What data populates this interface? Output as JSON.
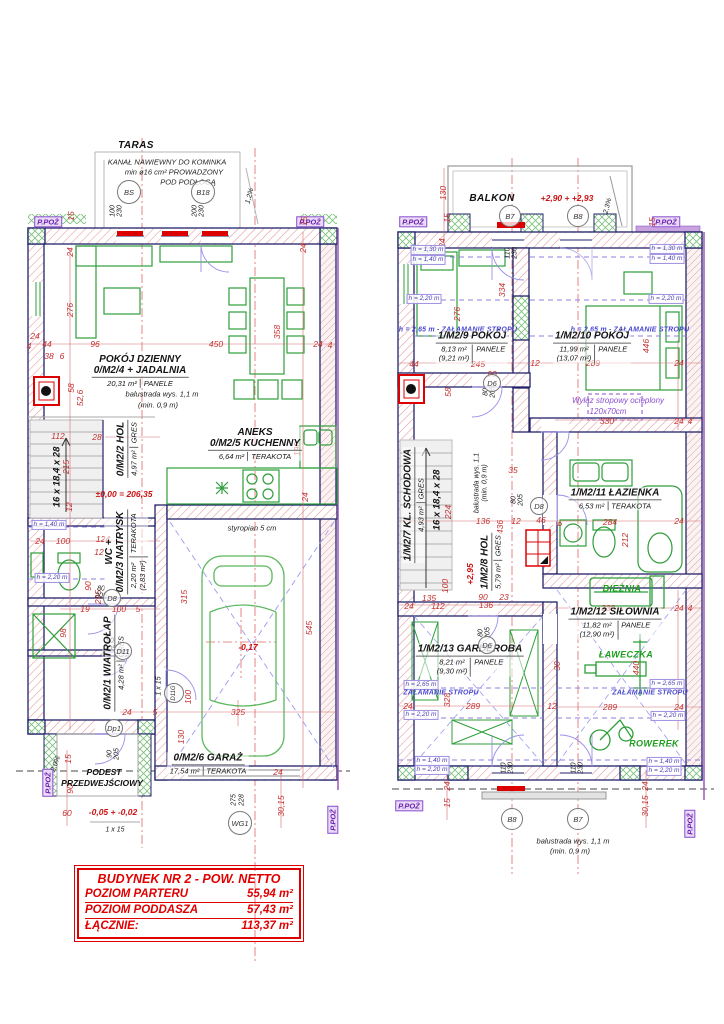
{
  "summary": {
    "header": "BUDYNEK NR 2 - POW. NETTO",
    "rows": [
      {
        "label": "POZIOM PARTERU",
        "value": "55,94 m²"
      },
      {
        "label": "POZIOM PODDASZA",
        "value": "57,43 m²"
      },
      {
        "label": "ŁĄCZNIE:",
        "value": "113,37 m²"
      }
    ]
  },
  "colors": {
    "wall_outline": "#23236b",
    "dimension_red": "#c43030",
    "furniture_green": "#2e9e3a",
    "fire_purple": "#8a4fd0",
    "table_red": "#e10000"
  },
  "rooms": [
    {
      "id": "0/M2/4",
      "name": "POKÓJ DZIENNY",
      "name2": "+ JADALNIA",
      "area": "20,31 m²",
      "finish": "PANELE",
      "x": 140,
      "y": 371,
      "vert": false
    },
    {
      "id": "0/M2/5",
      "name": "ANEKS",
      "name2": "KUCHENNY",
      "area": "6,64 m²",
      "finish": "TERAKOTA",
      "x": 255,
      "y": 444,
      "vert": false
    },
    {
      "id": "0/M2/2",
      "name": "HOL",
      "area": "4,97 m²",
      "finish": "GRES",
      "x": 127,
      "y": 449,
      "vert": true
    },
    {
      "id": "0/M2/3",
      "name": "WC +",
      "name2": "NATRYSK",
      "area": "2,20 m²",
      "area2": "(2,83 m²)",
      "finish": "TERAKOTA",
      "x": 126,
      "y": 552,
      "vert": true
    },
    {
      "id": "0/M2/1",
      "name": "WIATROŁAP",
      "area": "4,28 m²",
      "finish": "GRES",
      "x": 114,
      "y": 663,
      "vert": true
    },
    {
      "id": "0/M2/6",
      "name": "GARAŻ",
      "area": "17,54 m²",
      "finish": "TERAKOTA",
      "x": 208,
      "y": 764,
      "vert": false
    },
    {
      "id": "1/M2/9",
      "name": "POKÓJ",
      "area": "8,13 m²",
      "area2": "(9,21 m²)",
      "finish": "PANELE",
      "x": 472,
      "y": 347,
      "vert": false
    },
    {
      "id": "1/M2/10",
      "name": "POKÓJ",
      "area": "11,99 m²",
      "area2": "(13,07 m²)",
      "finish": "PANELE",
      "x": 592,
      "y": 347,
      "vert": false
    },
    {
      "id": "1/M2/7",
      "name": "KL. SCHODOWA",
      "area": "4,93 m²",
      "finish": "GRES",
      "x": 414,
      "y": 505,
      "vert": true
    },
    {
      "id": "1/M2/8",
      "name": "HOL",
      "area": "5,79 m²",
      "finish": "GRES",
      "x": 491,
      "y": 562,
      "vert": true
    },
    {
      "id": "1/M2/11",
      "name": "ŁAZIENKA",
      "area": "6,53 m²",
      "finish": "TERAKOTA",
      "x": 615,
      "y": 499,
      "vert": false
    },
    {
      "id": "1/M2/12",
      "name": "SIŁOWNIA",
      "area": "11,82 m²",
      "area2": "(12,90 m²)",
      "finish": "PANELE",
      "x": 615,
      "y": 623,
      "vert": false
    },
    {
      "id": "1/M2/13",
      "name": "GARDEROBA",
      "area": "8,21 m²",
      "area2": "(9,30 m²)",
      "finish": "PANELE",
      "x": 470,
      "y": 660,
      "vert": false
    }
  ],
  "markers": [
    {
      "t": "BS",
      "x": 129,
      "y": 192,
      "r": 11
    },
    {
      "t": "B18",
      "x": 203,
      "y": 192,
      "r": 11
    },
    {
      "t": "D8",
      "x": 112,
      "y": 598,
      "r": 8
    },
    {
      "t": "D11",
      "x": 123,
      "y": 651,
      "r": 8
    },
    {
      "t": "D11G",
      "x": 174,
      "y": 693,
      "r": 9,
      "rot": -90
    },
    {
      "t": "Dp1",
      "x": 114,
      "y": 728,
      "r": 8
    },
    {
      "t": "WG1",
      "x": 240,
      "y": 823,
      "r": 11
    },
    {
      "t": "B7",
      "x": 510,
      "y": 216,
      "r": 10
    },
    {
      "t": "B8",
      "x": 578,
      "y": 216,
      "r": 10
    },
    {
      "t": "D6",
      "x": 492,
      "y": 383,
      "r": 8
    },
    {
      "t": "D8",
      "x": 539,
      "y": 506,
      "r": 8
    },
    {
      "t": "D6",
      "x": 487,
      "y": 645,
      "r": 8
    },
    {
      "t": "B8",
      "x": 512,
      "y": 819,
      "r": 10
    },
    {
      "t": "B7",
      "x": 578,
      "y": 819,
      "r": 10
    }
  ],
  "annotations": [
    {
      "t": "TARAS",
      "x": 136,
      "y": 146,
      "c": "nb"
    },
    {
      "t": "KANAŁ NAWIEWNY DO KOMINKA",
      "x": 167,
      "y": 162,
      "c": "n"
    },
    {
      "t": "min ø16 cm² PROWADZONY",
      "x": 174,
      "y": 172,
      "c": "n"
    },
    {
      "t": "POD PODŁOGĄ",
      "x": 188,
      "y": 182,
      "c": "n"
    },
    {
      "t": "100",
      "x": 113,
      "y": 211,
      "c": "k",
      "r": -90
    },
    {
      "t": "230",
      "x": 120,
      "y": 211,
      "c": "k",
      "r": -90
    },
    {
      "t": "200",
      "x": 195,
      "y": 211,
      "c": "k",
      "r": -90
    },
    {
      "t": "230",
      "x": 202,
      "y": 211,
      "c": "k",
      "r": -90
    },
    {
      "t": "1,2%",
      "x": 250,
      "y": 196,
      "c": "k",
      "r": -75
    },
    {
      "t": "P.POŻ",
      "x": 48,
      "y": 222,
      "c": "p"
    },
    {
      "t": "P.POŻ",
      "x": 310,
      "y": 222,
      "c": "p"
    },
    {
      "t": "15",
      "x": 304,
      "y": 221,
      "r": -90
    },
    {
      "t": "24",
      "x": 303,
      "y": 248,
      "r": -90
    },
    {
      "t": "15",
      "x": 71,
      "y": 216,
      "r": -90
    },
    {
      "t": "24",
      "x": 70,
      "y": 252,
      "r": -90
    },
    {
      "t": "276",
      "x": 70,
      "y": 310,
      "r": -90
    },
    {
      "t": "96",
      "x": 95,
      "y": 344
    },
    {
      "t": "44",
      "x": 47,
      "y": 344
    },
    {
      "t": "38",
      "x": 49,
      "y": 356
    },
    {
      "t": "6",
      "x": 62,
      "y": 356
    },
    {
      "t": "24",
      "x": 35,
      "y": 336
    },
    {
      "t": "4",
      "x": 29,
      "y": 346
    },
    {
      "t": "58",
      "x": 71,
      "y": 388,
      "r": -90
    },
    {
      "t": "52,6",
      "x": 80,
      "y": 398,
      "r": -90
    },
    {
      "t": "450",
      "x": 216,
      "y": 344
    },
    {
      "t": "358",
      "x": 277,
      "y": 332,
      "r": -90
    },
    {
      "t": "24",
      "x": 318,
      "y": 344
    },
    {
      "t": "4",
      "x": 330,
      "y": 345
    },
    {
      "t": "balustrada wys. 1,1 m",
      "x": 162,
      "y": 394,
      "c": "n"
    },
    {
      "t": "(min. 0,9 m)",
      "x": 158,
      "y": 405,
      "c": "n"
    },
    {
      "t": "112",
      "x": 58,
      "y": 436
    },
    {
      "t": "28",
      "x": 97,
      "y": 437
    },
    {
      "t": "215",
      "x": 66,
      "y": 467,
      "r": -90
    },
    {
      "t": "16 x 18,4 x 28",
      "x": 57,
      "y": 477,
      "c": "kb",
      "r": -90
    },
    {
      "t": "190",
      "x": 297,
      "y": 449,
      "r": -90
    },
    {
      "t": "±0,00 = 206,35",
      "x": 124,
      "y": 494,
      "c": "lv"
    },
    {
      "t": "12",
      "x": 69,
      "y": 507,
      "r": -90
    },
    {
      "t": "24",
      "x": 40,
      "y": 541
    },
    {
      "t": "100",
      "x": 63,
      "y": 541
    },
    {
      "t": "124",
      "x": 103,
      "y": 539
    },
    {
      "t": "12",
      "x": 99,
      "y": 552
    },
    {
      "t": "h = 1,40 m",
      "x": 49,
      "y": 525,
      "c": "hb"
    },
    {
      "t": "h = 2,20 m",
      "x": 52,
      "y": 578,
      "c": "hb"
    },
    {
      "t": "90",
      "x": 88,
      "y": 586,
      "r": -90
    },
    {
      "t": "295",
      "x": 98,
      "y": 597,
      "r": -90
    },
    {
      "t": "80",
      "x": 101,
      "y": 589,
      "c": "k"
    },
    {
      "t": "205",
      "x": 101,
      "y": 596,
      "c": "k"
    },
    {
      "t": "19",
      "x": 85,
      "y": 609
    },
    {
      "t": "100",
      "x": 119,
      "y": 609
    },
    {
      "t": "5",
      "x": 138,
      "y": 609
    },
    {
      "t": "98",
      "x": 63,
      "y": 633,
      "r": -90
    },
    {
      "t": "90",
      "x": 110,
      "y": 641,
      "c": "k"
    },
    {
      "t": "205",
      "x": 110,
      "y": 649,
      "c": "k"
    },
    {
      "t": "315",
      "x": 184,
      "y": 597,
      "r": -90
    },
    {
      "t": "1 x 15",
      "x": 159,
      "y": 686,
      "c": "k",
      "r": -90
    },
    {
      "t": "24",
      "x": 127,
      "y": 712
    },
    {
      "t": "5",
      "x": 155,
      "y": 712
    },
    {
      "t": "100",
      "x": 188,
      "y": 697,
      "r": -90
    },
    {
      "t": "325",
      "x": 238,
      "y": 712
    },
    {
      "t": "130",
      "x": 181,
      "y": 737,
      "r": -90
    },
    {
      "t": "545",
      "x": 309,
      "y": 628,
      "r": -90
    },
    {
      "t": "-0,17",
      "x": 248,
      "y": 647,
      "c": "lv"
    },
    {
      "t": "styropian 5 cm",
      "x": 252,
      "y": 528,
      "c": "n"
    },
    {
      "t": "24",
      "x": 305,
      "y": 497,
      "r": -90
    },
    {
      "t": "24",
      "x": 278,
      "y": 772
    },
    {
      "t": "30,15",
      "x": 281,
      "y": 806,
      "r": -90
    },
    {
      "t": "275",
      "x": 234,
      "y": 800,
      "c": "k",
      "r": -90
    },
    {
      "t": "228",
      "x": 242,
      "y": 800,
      "c": "k",
      "r": -90
    },
    {
      "t": "P.POŻ",
      "x": 48,
      "y": 783,
      "c": "p",
      "r": -90
    },
    {
      "t": "2,0%",
      "x": 56,
      "y": 764,
      "c": "k",
      "r": -70
    },
    {
      "t": "15",
      "x": 68,
      "y": 759,
      "r": -90
    },
    {
      "t": "90",
      "x": 70,
      "y": 789,
      "r": -90
    },
    {
      "t": "60",
      "x": 67,
      "y": 813
    },
    {
      "t": "-0,05 + -0,02",
      "x": 113,
      "y": 812,
      "c": "lv"
    },
    {
      "t": "1 x 15",
      "x": 115,
      "y": 830,
      "c": "k"
    },
    {
      "t": "90",
      "x": 110,
      "y": 754,
      "c": "k",
      "r": -90
    },
    {
      "t": "205",
      "x": 117,
      "y": 754,
      "c": "k",
      "r": -90
    },
    {
      "t": "PODEST",
      "x": 104,
      "y": 772,
      "c": "nb2"
    },
    {
      "t": "PRZEDWEJŚCIOWY",
      "x": 102,
      "y": 783,
      "c": "nb2"
    },
    {
      "t": "P.POŻ",
      "x": 333,
      "y": 820,
      "c": "p",
      "r": -90
    },
    {
      "t": "BALKON",
      "x": 492,
      "y": 199,
      "c": "nb"
    },
    {
      "t": "+2,90 + +2,93",
      "x": 567,
      "y": 198,
      "c": "lv"
    },
    {
      "t": "2,3%",
      "x": 608,
      "y": 206,
      "c": "k",
      "r": -75
    },
    {
      "t": "130",
      "x": 443,
      "y": 193,
      "r": -90
    },
    {
      "t": "15",
      "x": 447,
      "y": 218,
      "r": -90
    },
    {
      "t": "24",
      "x": 442,
      "y": 243,
      "r": -90
    },
    {
      "t": "P.POŻ",
      "x": 413,
      "y": 222,
      "c": "p"
    },
    {
      "t": "P.POŻ",
      "x": 666,
      "y": 222,
      "c": "p"
    },
    {
      "t": "15",
      "x": 652,
      "y": 222,
      "r": -90
    },
    {
      "t": "110",
      "x": 508,
      "y": 253,
      "c": "k",
      "r": -90
    },
    {
      "t": "230",
      "x": 515,
      "y": 253,
      "c": "k",
      "r": -90
    },
    {
      "t": "h = 1,30 m",
      "x": 428,
      "y": 250,
      "c": "hb"
    },
    {
      "t": "h = 1,40 m",
      "x": 428,
      "y": 260,
      "c": "hb"
    },
    {
      "t": "h = 2,20 m",
      "x": 424,
      "y": 299,
      "c": "hb"
    },
    {
      "t": "h = 2,65 m - ZAŁAMANIE STROPU",
      "x": 458,
      "y": 330,
      "c": "st"
    },
    {
      "t": "h = 1,30 m",
      "x": 667,
      "y": 249,
      "c": "hb"
    },
    {
      "t": "h = 1,40 m",
      "x": 667,
      "y": 259,
      "c": "hb"
    },
    {
      "t": "h = 2,20 m",
      "x": 666,
      "y": 299,
      "c": "hb"
    },
    {
      "t": "h = 2,65 m - ZAŁAMANIE STROPU",
      "x": 630,
      "y": 330,
      "c": "st"
    },
    {
      "t": "334",
      "x": 502,
      "y": 290,
      "r": -90
    },
    {
      "t": "276",
      "x": 457,
      "y": 314,
      "r": -90
    },
    {
      "t": "44",
      "x": 414,
      "y": 364
    },
    {
      "t": "245",
      "x": 478,
      "y": 364
    },
    {
      "t": "58",
      "x": 448,
      "y": 392,
      "r": -90
    },
    {
      "t": "90",
      "x": 492,
      "y": 374
    },
    {
      "t": "80",
      "x": 486,
      "y": 392,
      "c": "k",
      "r": -90
    },
    {
      "t": "205",
      "x": 493,
      "y": 392,
      "c": "k",
      "r": -90
    },
    {
      "t": "12",
      "x": 535,
      "y": 363
    },
    {
      "t": "289",
      "x": 593,
      "y": 363
    },
    {
      "t": "24",
      "x": 679,
      "y": 363
    },
    {
      "t": "446",
      "x": 646,
      "y": 346,
      "r": -90
    },
    {
      "t": "Wyłaz stropowy ocieplony",
      "x": 618,
      "y": 401,
      "c": "vi"
    },
    {
      "t": "120x70cm",
      "x": 608,
      "y": 412,
      "c": "vi"
    },
    {
      "t": "330",
      "x": 607,
      "y": 421
    },
    {
      "t": "24",
      "x": 679,
      "y": 421
    },
    {
      "t": "4",
      "x": 690,
      "y": 421
    },
    {
      "t": "224",
      "x": 448,
      "y": 512,
      "r": -90
    },
    {
      "t": "16 x 18,4 x 28",
      "x": 437,
      "y": 500,
      "c": "kb",
      "r": -90
    },
    {
      "t": "+2,95",
      "x": 470,
      "y": 574,
      "c": "lv",
      "r": -90
    },
    {
      "t": "100",
      "x": 445,
      "y": 586,
      "r": -90
    },
    {
      "t": "135",
      "x": 429,
      "y": 598
    },
    {
      "t": "112",
      "x": 438,
      "y": 606
    },
    {
      "t": "24",
      "x": 409,
      "y": 606
    },
    {
      "t": "90",
      "x": 483,
      "y": 597
    },
    {
      "t": "23",
      "x": 504,
      "y": 597
    },
    {
      "t": "136",
      "x": 486,
      "y": 605
    },
    {
      "t": "136",
      "x": 483,
      "y": 521
    },
    {
      "t": "436",
      "x": 500,
      "y": 527,
      "r": -90
    },
    {
      "t": "12",
      "x": 516,
      "y": 521
    },
    {
      "t": "46",
      "x": 541,
      "y": 520
    },
    {
      "t": "6",
      "x": 559,
      "y": 524,
      "r": -90
    },
    {
      "t": "35",
      "x": 513,
      "y": 470
    },
    {
      "t": "balustrada wys. 1,1",
      "x": 477,
      "y": 483,
      "c": "k",
      "r": -90
    },
    {
      "t": "(min. 0,9 m)",
      "x": 485,
      "y": 483,
      "c": "k",
      "r": -90
    },
    {
      "t": "80",
      "x": 514,
      "y": 500,
      "c": "k",
      "r": -90
    },
    {
      "t": "205",
      "x": 521,
      "y": 500,
      "c": "k",
      "r": -90
    },
    {
      "t": "284",
      "x": 610,
      "y": 522
    },
    {
      "t": "24",
      "x": 679,
      "y": 521
    },
    {
      "t": "212",
      "x": 625,
      "y": 540,
      "r": -90
    },
    {
      "t": "BIEŻNIA",
      "x": 622,
      "y": 589,
      "c": "g"
    },
    {
      "t": "330",
      "x": 608,
      "y": 608
    },
    {
      "t": "24",
      "x": 679,
      "y": 608
    },
    {
      "t": "4",
      "x": 690,
      "y": 608
    },
    {
      "t": "ŁAWECZKA",
      "x": 626,
      "y": 655,
      "c": "g"
    },
    {
      "t": "440",
      "x": 636,
      "y": 668,
      "r": -90
    },
    {
      "t": "h = 2,65 m",
      "x": 667,
      "y": 684,
      "c": "hb"
    },
    {
      "t": "ZAŁAMANIE STROPU",
      "x": 650,
      "y": 693,
      "c": "st"
    },
    {
      "t": "289",
      "x": 610,
      "y": 707
    },
    {
      "t": "24",
      "x": 679,
      "y": 707
    },
    {
      "t": "h = 2,20 m",
      "x": 668,
      "y": 716,
      "c": "hb"
    },
    {
      "t": "ROWEREK",
      "x": 654,
      "y": 744,
      "c": "g"
    },
    {
      "t": "80",
      "x": 481,
      "y": 633,
      "c": "k",
      "r": -90
    },
    {
      "t": "205",
      "x": 488,
      "y": 633,
      "c": "k",
      "r": -90
    },
    {
      "t": "h = 2,65 m",
      "x": 421,
      "y": 685,
      "c": "hb"
    },
    {
      "t": "ZAŁAMANIE STROPU",
      "x": 441,
      "y": 693,
      "c": "st"
    },
    {
      "t": "328",
      "x": 447,
      "y": 700,
      "r": -90
    },
    {
      "t": "289",
      "x": 473,
      "y": 706
    },
    {
      "t": "24",
      "x": 408,
      "y": 706
    },
    {
      "t": "h = 2,20 m",
      "x": 421,
      "y": 715,
      "c": "hb"
    },
    {
      "t": "12",
      "x": 552,
      "y": 706
    },
    {
      "t": "30",
      "x": 557,
      "y": 666,
      "r": -90
    },
    {
      "t": "110",
      "x": 504,
      "y": 768,
      "c": "k",
      "r": -90
    },
    {
      "t": "230",
      "x": 511,
      "y": 768,
      "c": "k",
      "r": -90
    },
    {
      "t": "110",
      "x": 574,
      "y": 768,
      "c": "k",
      "r": -90
    },
    {
      "t": "230",
      "x": 581,
      "y": 768,
      "c": "k",
      "r": -90
    },
    {
      "t": "balustrada wys. 1,1 m",
      "x": 573,
      "y": 841,
      "c": "n"
    },
    {
      "t": "(min. 0,9 m)",
      "x": 570,
      "y": 851,
      "c": "n"
    },
    {
      "t": "24",
      "x": 447,
      "y": 786,
      "r": -90
    },
    {
      "t": "15",
      "x": 447,
      "y": 803,
      "r": -90
    },
    {
      "t": "24",
      "x": 645,
      "y": 786,
      "r": -90
    },
    {
      "t": "30,15",
      "x": 645,
      "y": 806,
      "r": -90
    },
    {
      "t": "P.POŻ",
      "x": 409,
      "y": 806,
      "c": "p"
    },
    {
      "t": "P.POŻ",
      "x": 690,
      "y": 824,
      "c": "p",
      "r": -90
    },
    {
      "t": "h = 1,40 m",
      "x": 432,
      "y": 761,
      "c": "hb"
    },
    {
      "t": "h = 2,20 m",
      "x": 432,
      "y": 770,
      "c": "hb"
    },
    {
      "t": "h = 1,40 m",
      "x": 664,
      "y": 762,
      "c": "hb"
    },
    {
      "t": "h = 2,20 m",
      "x": 664,
      "y": 771,
      "c": "hb"
    }
  ]
}
